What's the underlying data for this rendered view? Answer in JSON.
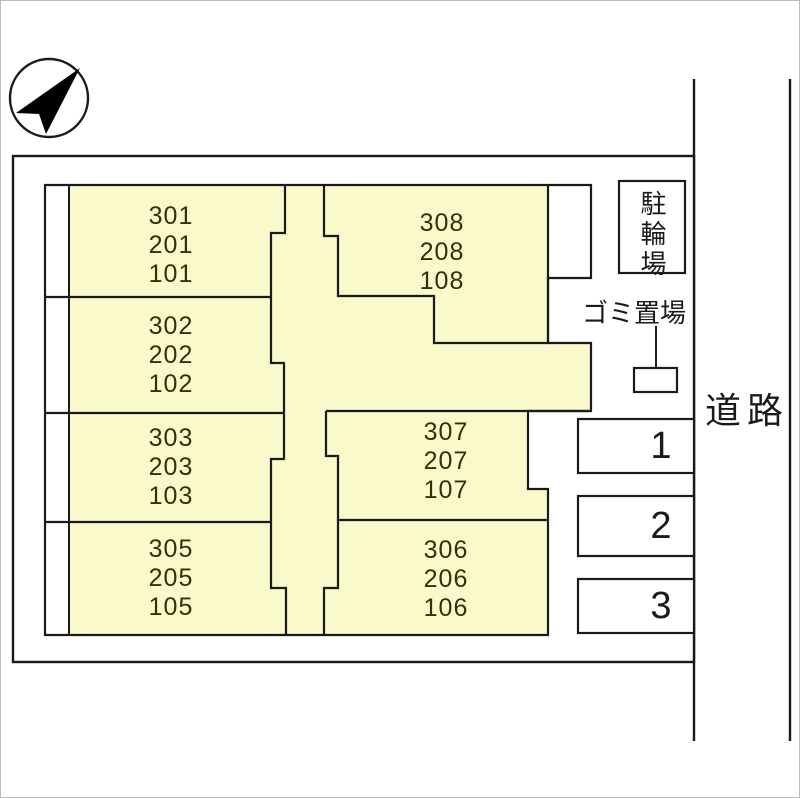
{
  "building": {
    "units": [
      {
        "id": "stack-01",
        "lines": [
          "301",
          "201",
          "101"
        ]
      },
      {
        "id": "stack-02",
        "lines": [
          "302",
          "202",
          "102"
        ]
      },
      {
        "id": "stack-03",
        "lines": [
          "303",
          "203",
          "103"
        ]
      },
      {
        "id": "stack-05",
        "lines": [
          "305",
          "205",
          "105"
        ]
      },
      {
        "id": "stack-08",
        "lines": [
          "308",
          "208",
          "108"
        ]
      },
      {
        "id": "stack-07",
        "lines": [
          "307",
          "207",
          "107"
        ]
      },
      {
        "id": "stack-06",
        "lines": [
          "306",
          "206",
          "106"
        ]
      }
    ]
  },
  "facilities": {
    "bicycle_parking": "駐輪場",
    "garbage_area": "ゴミ置場"
  },
  "road_label": "道路",
  "parking_spaces": [
    "1",
    "2",
    "3"
  ],
  "colors": {
    "building_fill": "#F9F9CB",
    "outline": "#1A1A1A",
    "background": "#FFFFFF"
  }
}
